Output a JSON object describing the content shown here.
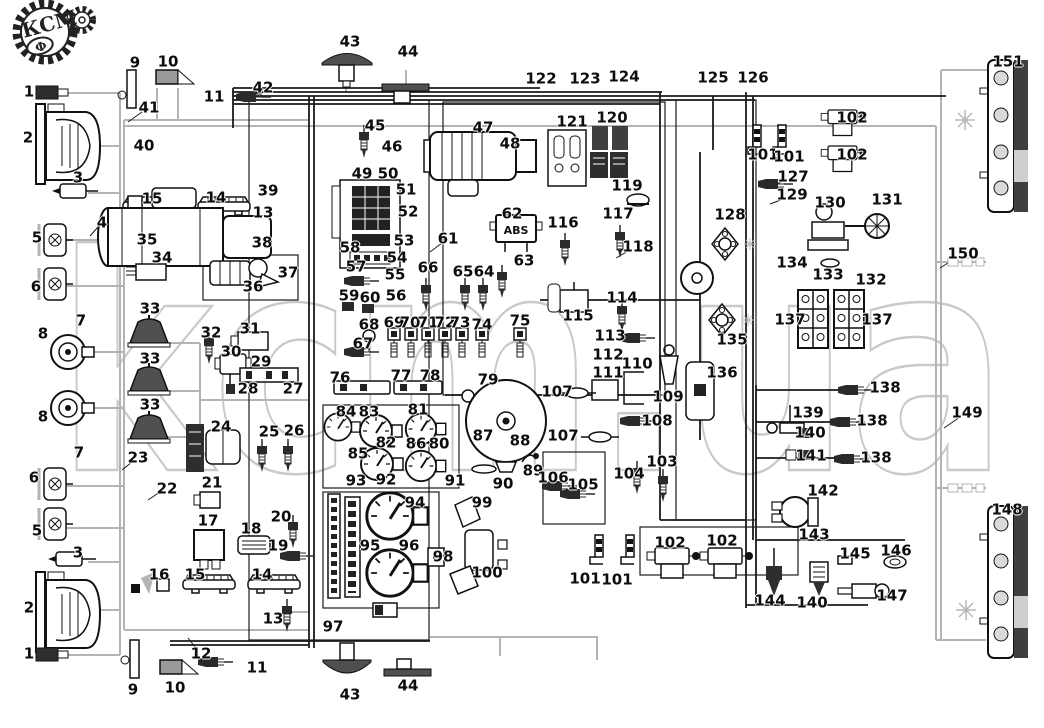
{
  "logo": {
    "text": "КСМ",
    "letter": "Ф"
  },
  "watermark": {
    "text": "kcm.ua"
  },
  "abs_unit": {
    "label": "ABS"
  },
  "colors": {
    "ink": "#1b1b1b",
    "wire_gray": "#b4b4b4",
    "dark_fill": "#4f4f4f",
    "watermark_gray": "#c9c9c9",
    "background": "#ffffff"
  },
  "diagram": {
    "labels": [
      {
        "n": "1",
        "x": 29,
        "y": 92
      },
      {
        "n": "1",
        "x": 29,
        "y": 654
      },
      {
        "n": "2",
        "x": 28,
        "y": 138
      },
      {
        "n": "2",
        "x": 29,
        "y": 608
      },
      {
        "n": "3",
        "x": 78,
        "y": 178
      },
      {
        "n": "3",
        "x": 78,
        "y": 553
      },
      {
        "n": "4",
        "x": 102,
        "y": 223
      },
      {
        "n": "5",
        "x": 37,
        "y": 238
      },
      {
        "n": "5",
        "x": 37,
        "y": 531
      },
      {
        "n": "6",
        "x": 36,
        "y": 287
      },
      {
        "n": "6",
        "x": 34,
        "y": 478
      },
      {
        "n": "7",
        "x": 81,
        "y": 321
      },
      {
        "n": "7",
        "x": 79,
        "y": 453
      },
      {
        "n": "8",
        "x": 43,
        "y": 334
      },
      {
        "n": "8",
        "x": 43,
        "y": 417
      },
      {
        "n": "9",
        "x": 135,
        "y": 63
      },
      {
        "n": "9",
        "x": 133,
        "y": 690
      },
      {
        "n": "10",
        "x": 168,
        "y": 62
      },
      {
        "n": "10",
        "x": 175,
        "y": 688
      },
      {
        "n": "11",
        "x": 214,
        "y": 97
      },
      {
        "n": "11",
        "x": 257,
        "y": 668
      },
      {
        "n": "12",
        "x": 201,
        "y": 654
      },
      {
        "n": "13",
        "x": 263,
        "y": 213
      },
      {
        "n": "13",
        "x": 273,
        "y": 619
      },
      {
        "n": "14",
        "x": 216,
        "y": 198
      },
      {
        "n": "14",
        "x": 262,
        "y": 575
      },
      {
        "n": "15",
        "x": 152,
        "y": 199
      },
      {
        "n": "15",
        "x": 195,
        "y": 575
      },
      {
        "n": "16",
        "x": 159,
        "y": 575
      },
      {
        "n": "17",
        "x": 208,
        "y": 521
      },
      {
        "n": "18",
        "x": 251,
        "y": 529
      },
      {
        "n": "19",
        "x": 278,
        "y": 546
      },
      {
        "n": "20",
        "x": 281,
        "y": 517
      },
      {
        "n": "21",
        "x": 212,
        "y": 483
      },
      {
        "n": "22",
        "x": 167,
        "y": 489
      },
      {
        "n": "23",
        "x": 138,
        "y": 458
      },
      {
        "n": "24",
        "x": 221,
        "y": 427
      },
      {
        "n": "25",
        "x": 269,
        "y": 432
      },
      {
        "n": "26",
        "x": 294,
        "y": 431
      },
      {
        "n": "27",
        "x": 293,
        "y": 389
      },
      {
        "n": "28",
        "x": 248,
        "y": 389
      },
      {
        "n": "29",
        "x": 261,
        "y": 362
      },
      {
        "n": "30",
        "x": 231,
        "y": 352
      },
      {
        "n": "31",
        "x": 250,
        "y": 329
      },
      {
        "n": "32",
        "x": 211,
        "y": 333
      },
      {
        "n": "33",
        "x": 150,
        "y": 309
      },
      {
        "n": "33",
        "x": 150,
        "y": 359
      },
      {
        "n": "33",
        "x": 150,
        "y": 405
      },
      {
        "n": "34",
        "x": 162,
        "y": 258
      },
      {
        "n": "35",
        "x": 147,
        "y": 240
      },
      {
        "n": "36",
        "x": 253,
        "y": 287
      },
      {
        "n": "37",
        "x": 288,
        "y": 273
      },
      {
        "n": "38",
        "x": 262,
        "y": 243
      },
      {
        "n": "39",
        "x": 268,
        "y": 191
      },
      {
        "n": "40",
        "x": 144,
        "y": 146
      },
      {
        "n": "41",
        "x": 149,
        "y": 108
      },
      {
        "n": "42",
        "x": 263,
        "y": 88
      },
      {
        "n": "43",
        "x": 350,
        "y": 42
      },
      {
        "n": "43",
        "x": 350,
        "y": 695
      },
      {
        "n": "44",
        "x": 408,
        "y": 52
      },
      {
        "n": "44",
        "x": 408,
        "y": 686
      },
      {
        "n": "45",
        "x": 375,
        "y": 126
      },
      {
        "n": "46",
        "x": 392,
        "y": 147
      },
      {
        "n": "47",
        "x": 483,
        "y": 128
      },
      {
        "n": "48",
        "x": 510,
        "y": 144
      },
      {
        "n": "49",
        "x": 362,
        "y": 174
      },
      {
        "n": "50",
        "x": 388,
        "y": 174
      },
      {
        "n": "51",
        "x": 406,
        "y": 190
      },
      {
        "n": "52",
        "x": 408,
        "y": 212
      },
      {
        "n": "53",
        "x": 404,
        "y": 241
      },
      {
        "n": "54",
        "x": 397,
        "y": 258
      },
      {
        "n": "55",
        "x": 395,
        "y": 275
      },
      {
        "n": "56",
        "x": 396,
        "y": 296
      },
      {
        "n": "57",
        "x": 356,
        "y": 267
      },
      {
        "n": "58",
        "x": 350,
        "y": 248
      },
      {
        "n": "59",
        "x": 349,
        "y": 296
      },
      {
        "n": "60",
        "x": 370,
        "y": 298
      },
      {
        "n": "61",
        "x": 448,
        "y": 239
      },
      {
        "n": "62",
        "x": 512,
        "y": 214
      },
      {
        "n": "63",
        "x": 524,
        "y": 261
      },
      {
        "n": "64",
        "x": 484,
        "y": 272
      },
      {
        "n": "65",
        "x": 463,
        "y": 272
      },
      {
        "n": "66",
        "x": 428,
        "y": 268
      },
      {
        "n": "67",
        "x": 363,
        "y": 344
      },
      {
        "n": "68",
        "x": 369,
        "y": 325
      },
      {
        "n": "69",
        "x": 394,
        "y": 323
      },
      {
        "n": "70",
        "x": 410,
        "y": 323
      },
      {
        "n": "71",
        "x": 428,
        "y": 323
      },
      {
        "n": "72",
        "x": 445,
        "y": 323
      },
      {
        "n": "73",
        "x": 460,
        "y": 323
      },
      {
        "n": "74",
        "x": 482,
        "y": 325
      },
      {
        "n": "75",
        "x": 520,
        "y": 321
      },
      {
        "n": "76",
        "x": 340,
        "y": 378
      },
      {
        "n": "77",
        "x": 401,
        "y": 376
      },
      {
        "n": "78",
        "x": 430,
        "y": 376
      },
      {
        "n": "79",
        "x": 488,
        "y": 380
      },
      {
        "n": "80",
        "x": 439,
        "y": 444
      },
      {
        "n": "81",
        "x": 418,
        "y": 410
      },
      {
        "n": "82",
        "x": 386,
        "y": 443
      },
      {
        "n": "83",
        "x": 369,
        "y": 412
      },
      {
        "n": "84",
        "x": 346,
        "y": 412
      },
      {
        "n": "85",
        "x": 358,
        "y": 454
      },
      {
        "n": "86",
        "x": 416,
        "y": 444
      },
      {
        "n": "87",
        "x": 483,
        "y": 436
      },
      {
        "n": "88",
        "x": 520,
        "y": 441
      },
      {
        "n": "89",
        "x": 533,
        "y": 471
      },
      {
        "n": "90",
        "x": 503,
        "y": 484
      },
      {
        "n": "91",
        "x": 455,
        "y": 481
      },
      {
        "n": "92",
        "x": 386,
        "y": 480
      },
      {
        "n": "93",
        "x": 356,
        "y": 481
      },
      {
        "n": "94",
        "x": 415,
        "y": 503
      },
      {
        "n": "95",
        "x": 370,
        "y": 546
      },
      {
        "n": "96",
        "x": 409,
        "y": 546
      },
      {
        "n": "97",
        "x": 333,
        "y": 627
      },
      {
        "n": "98",
        "x": 443,
        "y": 557
      },
      {
        "n": "99",
        "x": 482,
        "y": 503
      },
      {
        "n": "100",
        "x": 487,
        "y": 573
      },
      {
        "n": "101",
        "x": 763,
        "y": 155
      },
      {
        "n": "101",
        "x": 789,
        "y": 157
      },
      {
        "n": "101",
        "x": 585,
        "y": 579
      },
      {
        "n": "101",
        "x": 617,
        "y": 580
      },
      {
        "n": "102",
        "x": 852,
        "y": 118
      },
      {
        "n": "102",
        "x": 852,
        "y": 155
      },
      {
        "n": "102",
        "x": 670,
        "y": 543
      },
      {
        "n": "102",
        "x": 722,
        "y": 541
      },
      {
        "n": "103",
        "x": 662,
        "y": 462
      },
      {
        "n": "104",
        "x": 629,
        "y": 474
      },
      {
        "n": "105",
        "x": 583,
        "y": 485
      },
      {
        "n": "106",
        "x": 553,
        "y": 478
      },
      {
        "n": "107",
        "x": 557,
        "y": 392
      },
      {
        "n": "107",
        "x": 563,
        "y": 436
      },
      {
        "n": "108",
        "x": 657,
        "y": 421
      },
      {
        "n": "109",
        "x": 668,
        "y": 397
      },
      {
        "n": "110",
        "x": 637,
        "y": 364
      },
      {
        "n": "111",
        "x": 608,
        "y": 373
      },
      {
        "n": "112",
        "x": 608,
        "y": 355
      },
      {
        "n": "113",
        "x": 610,
        "y": 336
      },
      {
        "n": "114",
        "x": 622,
        "y": 298
      },
      {
        "n": "115",
        "x": 578,
        "y": 316
      },
      {
        "n": "116",
        "x": 563,
        "y": 223
      },
      {
        "n": "117",
        "x": 618,
        "y": 214
      },
      {
        "n": "118",
        "x": 638,
        "y": 247
      },
      {
        "n": "119",
        "x": 627,
        "y": 186
      },
      {
        "n": "120",
        "x": 612,
        "y": 118
      },
      {
        "n": "121",
        "x": 572,
        "y": 122
      },
      {
        "n": "122",
        "x": 541,
        "y": 79
      },
      {
        "n": "123",
        "x": 585,
        "y": 79
      },
      {
        "n": "124",
        "x": 624,
        "y": 77
      },
      {
        "n": "125",
        "x": 713,
        "y": 78
      },
      {
        "n": "126",
        "x": 753,
        "y": 78
      },
      {
        "n": "127",
        "x": 793,
        "y": 177
      },
      {
        "n": "128",
        "x": 730,
        "y": 215
      },
      {
        "n": "129",
        "x": 792,
        "y": 195
      },
      {
        "n": "130",
        "x": 830,
        "y": 203
      },
      {
        "n": "131",
        "x": 887,
        "y": 200
      },
      {
        "n": "132",
        "x": 871,
        "y": 280
      },
      {
        "n": "133",
        "x": 828,
        "y": 275
      },
      {
        "n": "134",
        "x": 792,
        "y": 263
      },
      {
        "n": "135",
        "x": 732,
        "y": 340
      },
      {
        "n": "136",
        "x": 722,
        "y": 373
      },
      {
        "n": "137",
        "x": 790,
        "y": 320
      },
      {
        "n": "137",
        "x": 877,
        "y": 320
      },
      {
        "n": "138",
        "x": 885,
        "y": 388
      },
      {
        "n": "138",
        "x": 872,
        "y": 421
      },
      {
        "n": "138",
        "x": 876,
        "y": 458
      },
      {
        "n": "139",
        "x": 808,
        "y": 413
      },
      {
        "n": "140",
        "x": 810,
        "y": 433
      },
      {
        "n": "140",
        "x": 812,
        "y": 603
      },
      {
        "n": "141",
        "x": 811,
        "y": 456
      },
      {
        "n": "142",
        "x": 823,
        "y": 491
      },
      {
        "n": "143",
        "x": 814,
        "y": 535
      },
      {
        "n": "144",
        "x": 770,
        "y": 601
      },
      {
        "n": "145",
        "x": 855,
        "y": 554
      },
      {
        "n": "146",
        "x": 896,
        "y": 551
      },
      {
        "n": "147",
        "x": 892,
        "y": 596
      },
      {
        "n": "148",
        "x": 1007,
        "y": 510
      },
      {
        "n": "149",
        "x": 967,
        "y": 413
      },
      {
        "n": "150",
        "x": 963,
        "y": 254
      },
      {
        "n": "151",
        "x": 1008,
        "y": 62
      }
    ]
  }
}
